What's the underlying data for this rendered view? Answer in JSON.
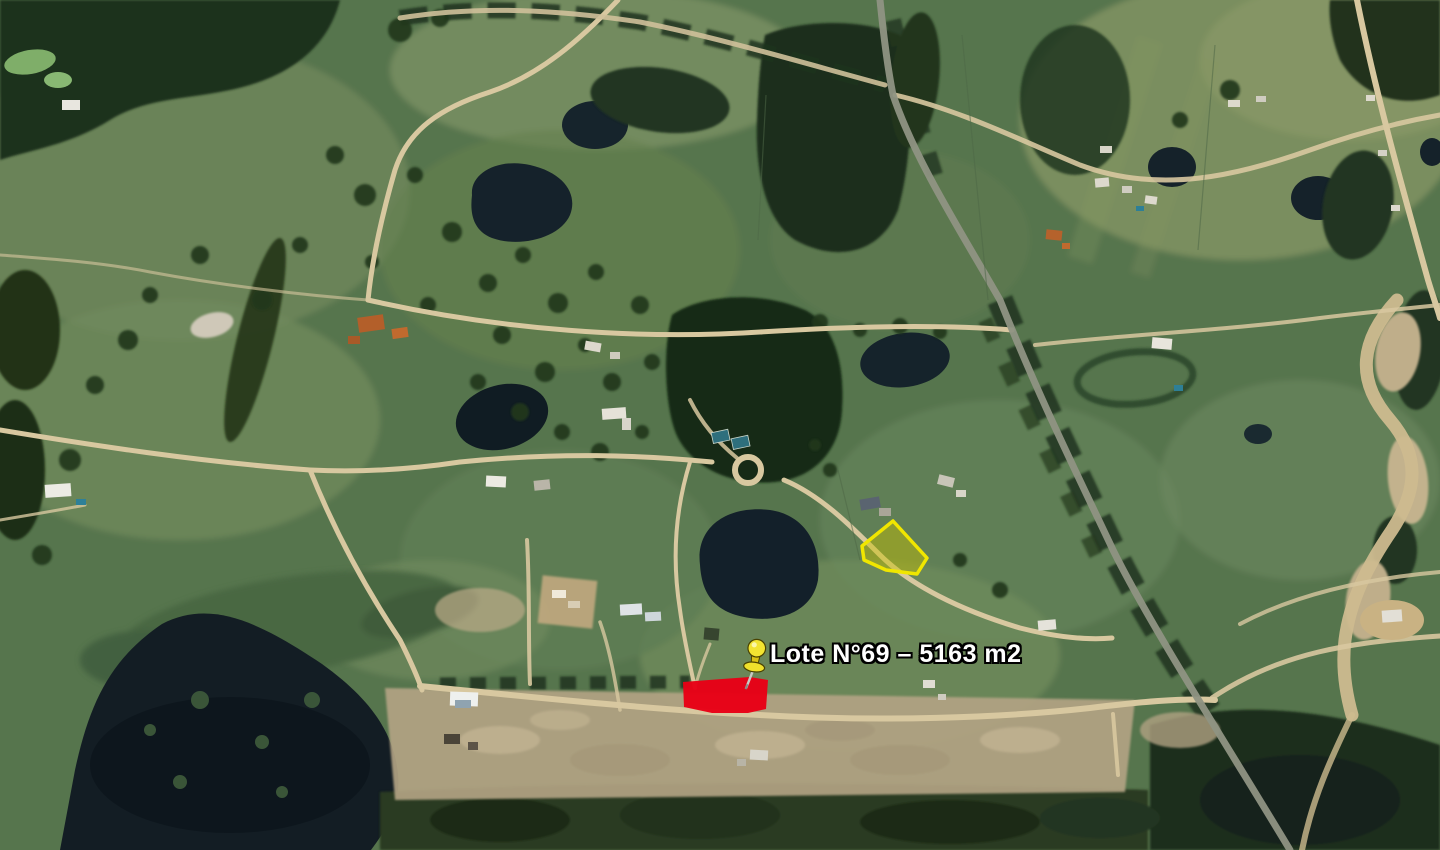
{
  "map": {
    "view": "satellite-imagery",
    "annotation": {
      "label": "Lote N°69 – 5163 m2",
      "lot": "Lote N°69",
      "area": "5163 m2"
    },
    "marker": {
      "icon": "pushpin-icon",
      "head_color": "#f2e431",
      "shade_color": "#d9c215",
      "needle_color": "#c9c9c4"
    },
    "parcels": {
      "selected": {
        "label": "Lote N°69",
        "fill": "#e80016"
      },
      "reference": {
        "stroke": "#f0e600",
        "fill": "#c8c000"
      }
    },
    "palette": {
      "field": "#57744e",
      "forest": "#1c2e1b",
      "water": "#14202a",
      "road": "#d8c8a0",
      "dirt": "#b2a383",
      "highway": "#8f9383"
    }
  }
}
